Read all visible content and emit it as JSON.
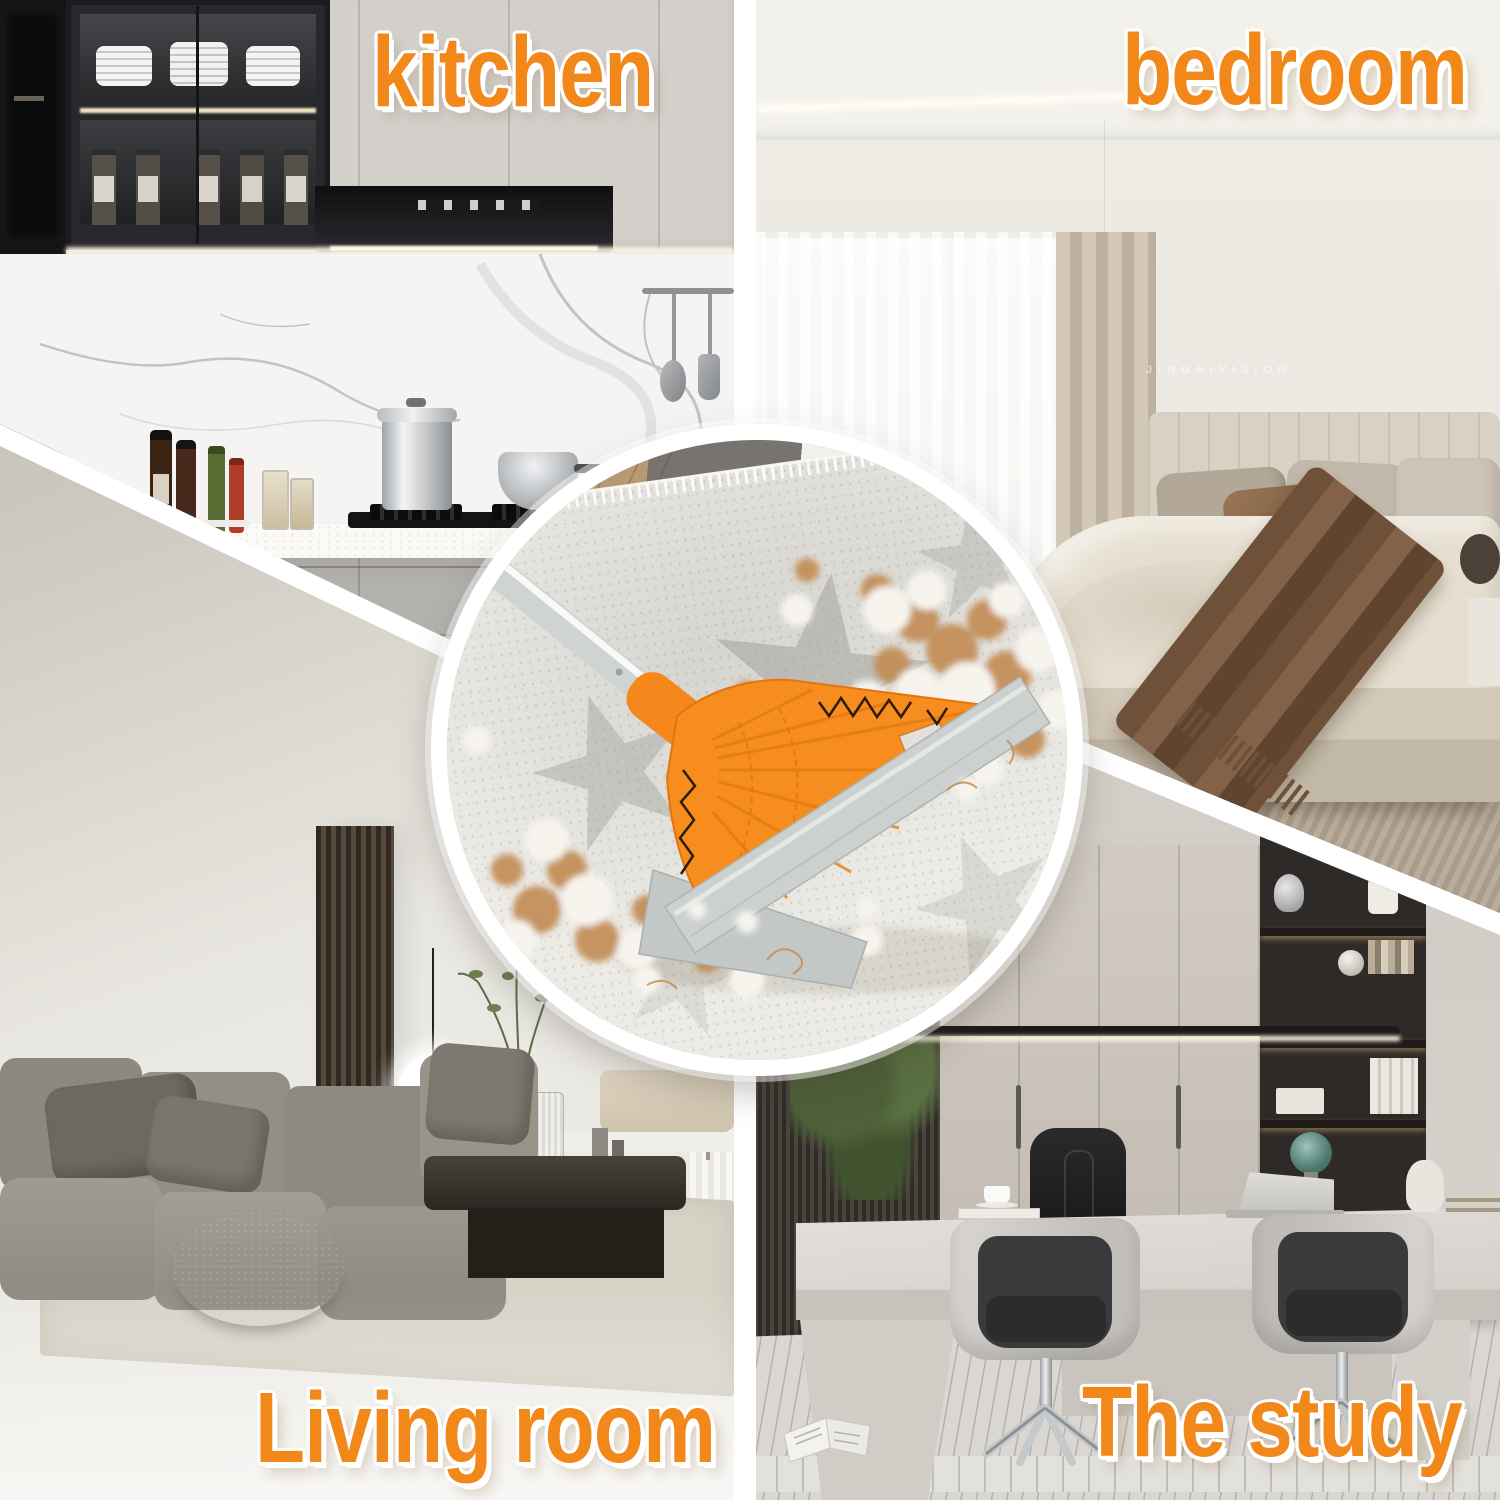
{
  "quadrants": {
    "kitchen": {
      "label": "kitchen"
    },
    "bedroom": {
      "label": "bedroom",
      "watermark": "JINGAIVISION"
    },
    "living_room": {
      "label": "Living room"
    },
    "study": {
      "label": "The study"
    }
  },
  "inset": {
    "colors": {
      "broom_head_orange": "#F78C1F",
      "broom_collar_orange": "#F5871C",
      "squeegee_blade_gray": "#CCD1CF",
      "handle_gray": "#CFD3D1",
      "carpet_white": "#ECEBE6",
      "fur_tan": "#C28C55",
      "fur_white": "#F7F4EE"
    }
  },
  "style": {
    "label_color": "#F2871A",
    "label_outline": "#FFFFFF",
    "divider_color": "#FFFFFF"
  }
}
